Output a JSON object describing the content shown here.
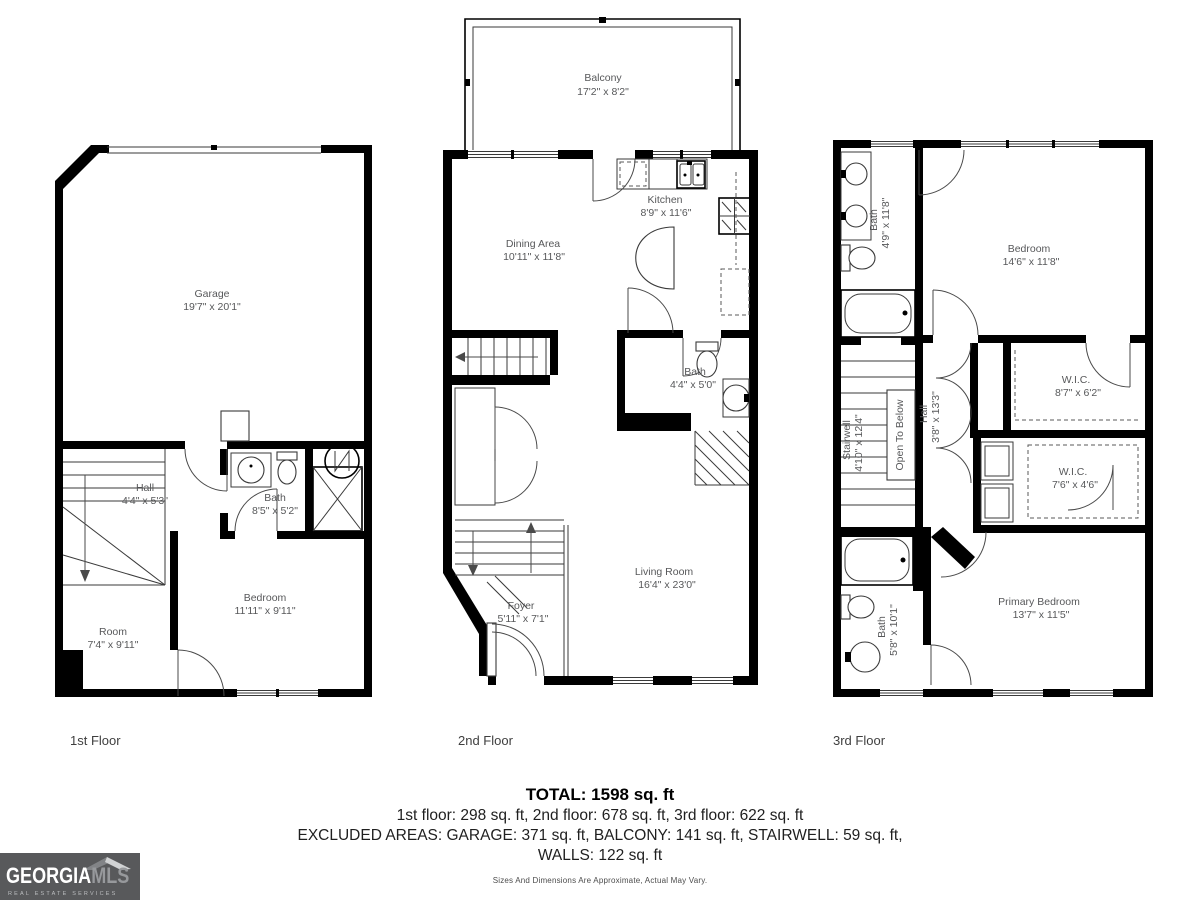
{
  "floors": [
    {
      "label": "1st Floor",
      "rooms": {
        "garage": {
          "name": "Garage",
          "dims": "19'7\" x 20'1\""
        },
        "hall": {
          "name": "Hall",
          "dims": "4'4\" x 5'3\""
        },
        "bath": {
          "name": "Bath",
          "dims": "8'5\" x 5'2\""
        },
        "bedroom": {
          "name": "Bedroom",
          "dims": "11'11\" x 9'11\""
        },
        "room": {
          "name": "Room",
          "dims": "7'4\" x 9'11\""
        }
      }
    },
    {
      "label": "2nd Floor",
      "rooms": {
        "balcony": {
          "name": "Balcony",
          "dims": "17'2\" x 8'2\""
        },
        "kitchen": {
          "name": "Kitchen",
          "dims": "8'9\" x 11'6\""
        },
        "dining": {
          "name": "Dining Area",
          "dims": "10'11\" x 11'8\""
        },
        "bath": {
          "name": "Bath",
          "dims": "4'4\" x 5'0\""
        },
        "living": {
          "name": "Living Room",
          "dims": "16'4\" x 23'0\""
        },
        "foyer": {
          "name": "Foyer",
          "dims": "5'11\" x 7'1\""
        }
      }
    },
    {
      "label": "3rd Floor",
      "rooms": {
        "bath_top": {
          "name": "Bath",
          "dims": "4'9\" x 11'8\""
        },
        "bedroom": {
          "name": "Bedroom",
          "dims": "14'6\" x 11'8\""
        },
        "stairwell": {
          "name": "Stairwell",
          "dims": "4'10\" x 12'4\""
        },
        "open_below": {
          "name": "Open To Below"
        },
        "hall": {
          "name": "Hall",
          "dims": "3'8\" x 13'3\""
        },
        "wic1": {
          "name": "W.I.C.",
          "dims": "8'7\" x 6'2\""
        },
        "wic2": {
          "name": "W.I.C.",
          "dims": "7'6\" x 4'6\""
        },
        "bath_bottom": {
          "name": "Bath",
          "dims": "5'8\" x 10'1\""
        },
        "primary": {
          "name": "Primary Bedroom",
          "dims": "13'7\" x 11'5\""
        }
      }
    }
  ],
  "summary": {
    "total": "TOTAL: 1598 sq. ft",
    "floors_line": "1st floor: 298 sq. ft, 2nd floor: 678 sq. ft, 3rd floor: 622 sq. ft",
    "excluded_line1": "EXCLUDED AREAS: GARAGE: 371 sq. ft, BALCONY: 141 sq. ft, STAIRWELL: 59 sq. ft,",
    "excluded_line2": "WALLS: 122 sq. ft",
    "disclaimer": "Sizes And Dimensions Are Approximate, Actual May Vary."
  },
  "logo": {
    "name": "GEORGIA",
    "name2": "MLS",
    "tagline": "REAL ESTATE SERVICES"
  },
  "colors": {
    "walls": "#000000",
    "room_label": "#57585a",
    "logo_background": "#58595b"
  }
}
